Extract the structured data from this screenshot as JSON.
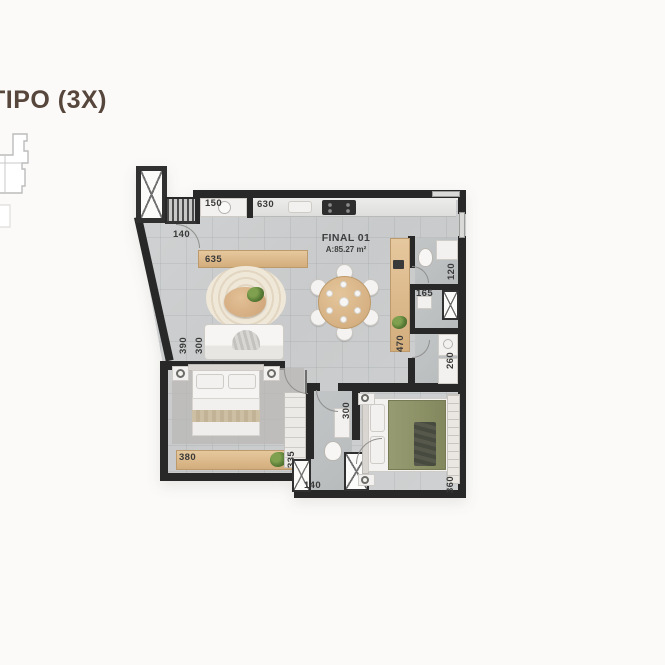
{
  "page": {
    "background": "#fbfaf8"
  },
  "header": {
    "title": "TIPO (3X)",
    "title_color": "#57463c"
  },
  "unit": {
    "name": "FINAL 01",
    "area": "A:85.27 m²"
  },
  "plan": {
    "colors": {
      "wall": "#282828",
      "floor": "#cbcdce",
      "wet_floor": "#bcc0c1",
      "wood": "#d9b78c",
      "olive_bed": "#8d9166",
      "rug_cream": "#ece3d3",
      "dim_text": "#3a3a3a"
    },
    "dims": [
      {
        "id": "service-width",
        "text": "150"
      },
      {
        "id": "kitchen-run",
        "text": "630"
      },
      {
        "id": "entry-hall-width",
        "text": "140"
      },
      {
        "id": "living-width",
        "text": "635"
      },
      {
        "id": "living-depth",
        "text": "390"
      },
      {
        "id": "living-wall",
        "text": "300"
      },
      {
        "id": "dining-sideboard",
        "text": "470"
      },
      {
        "id": "wc-width",
        "text": "120"
      },
      {
        "id": "shower-bath-width",
        "text": "165"
      },
      {
        "id": "laundry-depth",
        "text": "260"
      },
      {
        "id": "bedroom1-width",
        "text": "380"
      },
      {
        "id": "bedroom1-depth",
        "text": "335"
      },
      {
        "id": "bedroom2-width",
        "text": "300"
      },
      {
        "id": "bathroom-width",
        "text": "140"
      },
      {
        "id": "bedroom2-wardrobe",
        "text": "360"
      }
    ]
  }
}
